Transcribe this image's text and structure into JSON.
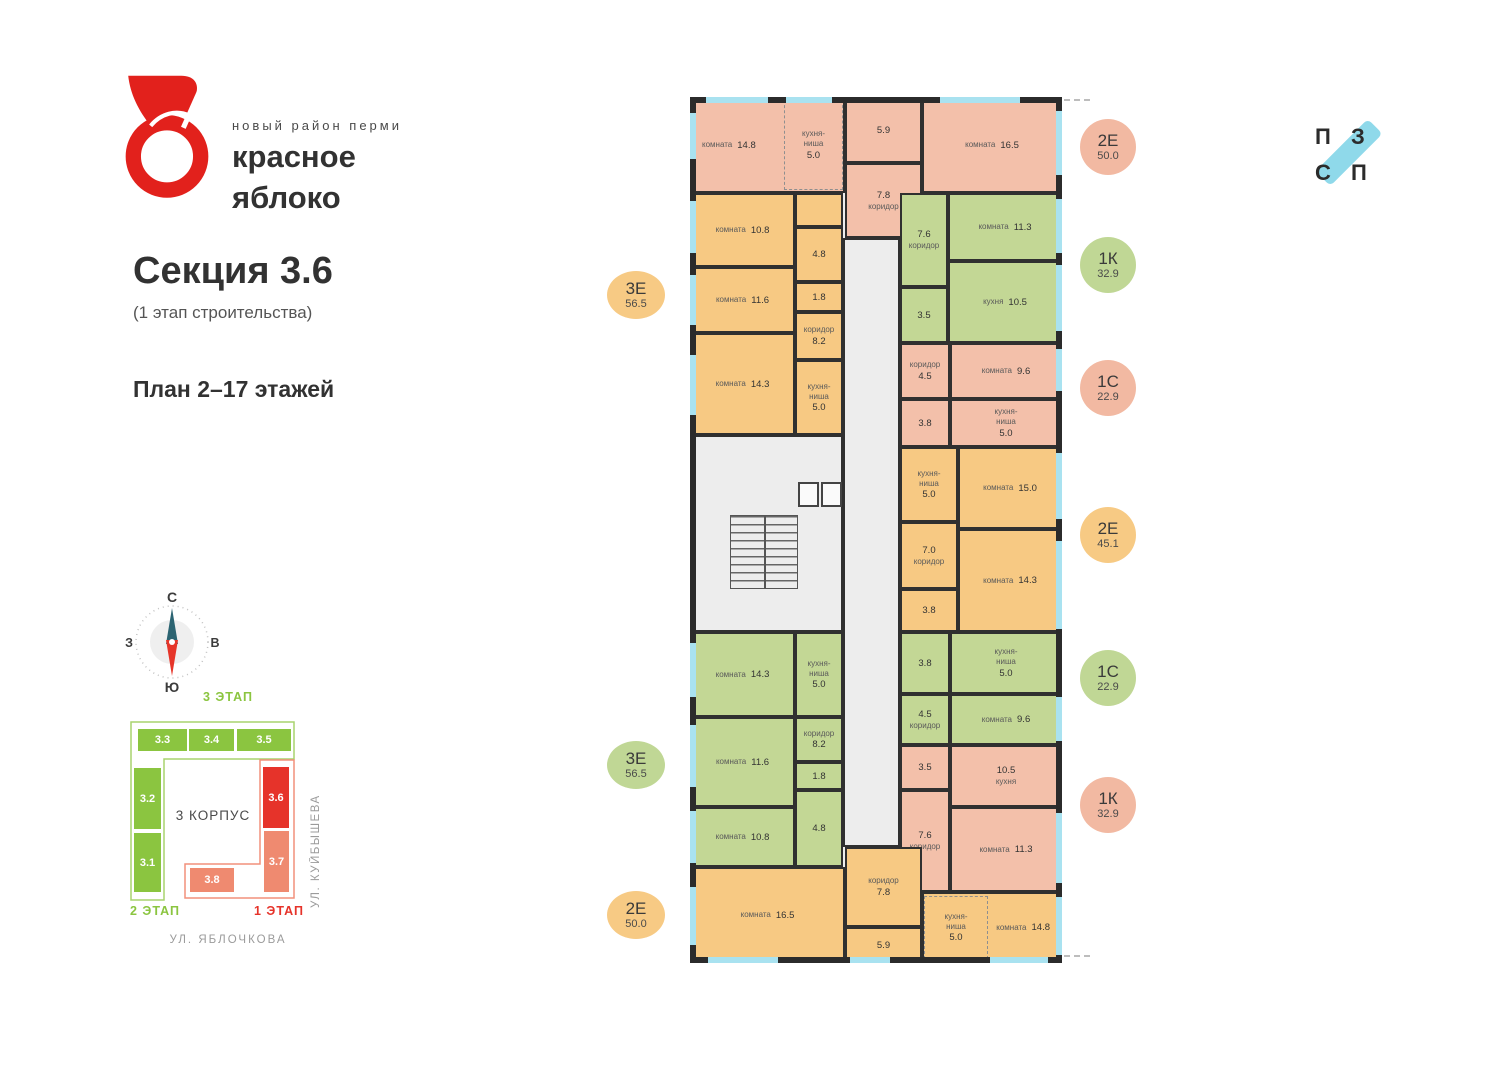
{
  "brand": {
    "tagline": "новый район перми",
    "line1": "красное",
    "line2": "яблоко"
  },
  "section": {
    "title": "Секция 3.6",
    "subtitle": "(1 этап строительства)",
    "floors": "План 2–17 этажей"
  },
  "compass": {
    "n": "С",
    "s": "Ю",
    "e": "В",
    "w": "З"
  },
  "partner": {
    "letters": [
      "П",
      "З",
      "С",
      "П"
    ],
    "bar_color": "#8fd9ea"
  },
  "minimap": {
    "stage3": "3 ЭТАП",
    "stage2": "2 ЭТАП",
    "stage1": "1 ЭТАП",
    "korpus": "3 КОРПУС",
    "street_right": "УЛ. КУЙБЫШЕВА",
    "street_bottom": "УЛ. ЯБЛОЧКОВА",
    "outline_green": "#a8d46e",
    "outline_red": "#f2907c",
    "sections": [
      {
        "label": "3.3",
        "color": "#8bc540",
        "r": [
          9,
          38,
          51,
          24
        ]
      },
      {
        "label": "3.4",
        "color": "#8bc540",
        "r": [
          60,
          38,
          47,
          24
        ]
      },
      {
        "label": "3.5",
        "color": "#8bc540",
        "r": [
          108,
          38,
          56,
          24
        ]
      },
      {
        "label": "3.2",
        "color": "#8bc540",
        "r": [
          5,
          77,
          29,
          63
        ]
      },
      {
        "label": "3.1",
        "color": "#8bc540",
        "r": [
          5,
          142,
          29,
          61
        ]
      },
      {
        "label": "3.6",
        "color": "#e6332a",
        "r": [
          134,
          76,
          28,
          63
        ]
      },
      {
        "label": "3.7",
        "color": "#ef8a70",
        "r": [
          135,
          140,
          27,
          63
        ]
      },
      {
        "label": "3.8",
        "color": "#ef8a70",
        "r": [
          61,
          177,
          46,
          26
        ]
      }
    ]
  },
  "badges_left": [
    {
      "t": "3Е",
      "a": "56.5",
      "color": "#f7ca84",
      "cy": 295
    },
    {
      "t": "3Е",
      "a": "56.5",
      "color": "#c0d795",
      "cy": 765
    },
    {
      "t": "2Е",
      "a": "50.0",
      "color": "#f7ca84",
      "cy": 915
    }
  ],
  "badges_right": [
    {
      "t": "2Е",
      "a": "50.0",
      "color": "#f2b9a2",
      "cy": 147
    },
    {
      "t": "1К",
      "a": "32.9",
      "color": "#c0d795",
      "cy": 265
    },
    {
      "t": "1С",
      "a": "22.9",
      "color": "#f2b9a2",
      "cy": 388
    },
    {
      "t": "2Е",
      "a": "45.1",
      "color": "#f7ca84",
      "cy": 535
    },
    {
      "t": "1С",
      "a": "22.9",
      "color": "#c0d795",
      "cy": 678
    },
    {
      "t": "1К",
      "a": "32.9",
      "color": "#f2b9a2",
      "cy": 805
    }
  ],
  "floorplan": {
    "colors": {
      "salmon": "#f3c0aa",
      "orange": "#f7c983",
      "green": "#c3d795",
      "common": "#ededed"
    },
    "rooms": [
      {
        "id": "corridor-central",
        "c": "common",
        "r": [
          153,
          141,
          57,
          609
        ]
      },
      {
        "id": "stair-core-block",
        "c": "common",
        "r": [
          0,
          338,
          153,
          197
        ]
      },
      {
        "id": "apt-2e50-top-room-1",
        "c": "salmon",
        "n": "комната",
        "a": "14.8",
        "r": [
          0,
          0,
          155,
          96
        ],
        "align": "L"
      },
      {
        "id": "apt-2e50-top-kitchen-niche",
        "c": "salmon",
        "n": "кухня-\nниша",
        "a": "5.0",
        "r": [
          94,
          3,
          59,
          90
        ],
        "dir": "col",
        "dashed": true
      },
      {
        "id": "apt-2e50-top-bath",
        "c": "salmon",
        "a": "5.9",
        "r": [
          155,
          0,
          77,
          66
        ]
      },
      {
        "id": "apt-2e50-top-hall",
        "c": "salmon",
        "n": "коридор",
        "a": "7.8",
        "r": [
          155,
          66,
          77,
          75
        ],
        "dir": "col",
        "af": true
      },
      {
        "id": "apt-2e50-top-room-2",
        "c": "salmon",
        "n": "комната",
        "a": "16.5",
        "r": [
          232,
          0,
          140,
          96
        ]
      },
      {
        "id": "apt-3e56-top-room-1",
        "c": "orange",
        "n": "комната",
        "a": "10.8",
        "r": [
          0,
          96,
          105,
          74
        ]
      },
      {
        "id": "apt-3e56-top-closet",
        "c": "orange",
        "r": [
          105,
          96,
          48,
          34
        ]
      },
      {
        "id": "apt-3e56-top-bath",
        "c": "orange",
        "a": "4.8",
        "r": [
          105,
          130,
          48,
          55
        ]
      },
      {
        "id": "apt-3e56-top-room-2",
        "c": "orange",
        "n": "комната",
        "a": "11.6",
        "r": [
          0,
          170,
          105,
          66
        ]
      },
      {
        "id": "apt-3e56-top-wc",
        "c": "orange",
        "a": "1.8",
        "r": [
          105,
          185,
          48,
          30
        ]
      },
      {
        "id": "apt-3e56-top-hall",
        "c": "orange",
        "n": "коридор",
        "a": "8.2",
        "r": [
          105,
          215,
          48,
          48
        ],
        "dir": "col"
      },
      {
        "id": "apt-3e56-top-room-3",
        "c": "orange",
        "n": "комната",
        "a": "14.3",
        "r": [
          0,
          236,
          105,
          102
        ]
      },
      {
        "id": "apt-3e56-top-kitchen-niche",
        "c": "orange",
        "n": "кухня-\nниша",
        "a": "5.0",
        "r": [
          105,
          263,
          48,
          75
        ],
        "dir": "col"
      },
      {
        "id": "apt-1k32-top-hall",
        "c": "green",
        "n": "коридор",
        "a": "7.6",
        "r": [
          210,
          96,
          48,
          94
        ],
        "dir": "col",
        "af": true
      },
      {
        "id": "apt-1k32-top-room",
        "c": "green",
        "n": "комната",
        "a": "11.3",
        "r": [
          258,
          96,
          114,
          68
        ]
      },
      {
        "id": "apt-1k32-top-bath",
        "c": "green",
        "a": "3.5",
        "r": [
          210,
          190,
          48,
          56
        ]
      },
      {
        "id": "apt-1k32-top-kitchen",
        "c": "green",
        "n": "кухня",
        "a": "10.5",
        "r": [
          258,
          164,
          114,
          82
        ]
      },
      {
        "id": "apt-1s22-top-hall",
        "c": "salmon",
        "n": "коридор",
        "a": "4.5",
        "r": [
          210,
          246,
          50,
          56
        ],
        "dir": "col"
      },
      {
        "id": "apt-1s22-top-room",
        "c": "salmon",
        "n": "комната",
        "a": "9.6",
        "r": [
          260,
          246,
          112,
          56
        ]
      },
      {
        "id": "apt-1s22-top-bath",
        "c": "salmon",
        "a": "3.8",
        "r": [
          210,
          302,
          50,
          48
        ]
      },
      {
        "id": "apt-1s22-top-kitchen-niche",
        "c": "salmon",
        "n": "кухня-\nниша",
        "a": "5.0",
        "r": [
          260,
          302,
          112,
          48
        ],
        "dir": "col"
      },
      {
        "id": "apt-2e45-kitchen-niche",
        "c": "orange",
        "n": "кухня-\nниша",
        "a": "5.0",
        "r": [
          210,
          350,
          58,
          75
        ],
        "dir": "col"
      },
      {
        "id": "apt-2e45-room-1",
        "c": "orange",
        "n": "комната",
        "a": "15.0",
        "r": [
          268,
          350,
          104,
          82
        ]
      },
      {
        "id": "apt-2e45-hall",
        "c": "orange",
        "n": "коридор",
        "a": "7.0",
        "r": [
          210,
          425,
          58,
          67
        ],
        "dir": "col",
        "af": true
      },
      {
        "id": "apt-2e45-room-2",
        "c": "orange",
        "n": "комната",
        "a": "14.3",
        "r": [
          268,
          432,
          104,
          103
        ]
      },
      {
        "id": "apt-2e45-bath",
        "c": "orange",
        "a": "3.8",
        "r": [
          210,
          492,
          58,
          43
        ]
      },
      {
        "id": "apt-1s22-mid-bath",
        "c": "green",
        "a": "3.8",
        "r": [
          210,
          535,
          50,
          62
        ]
      },
      {
        "id": "apt-1s22-mid-kitchen-niche",
        "c": "green",
        "n": "кухня-\nниша",
        "a": "5.0",
        "r": [
          260,
          535,
          112,
          62
        ],
        "dir": "col"
      },
      {
        "id": "apt-1s22-mid-hall",
        "c": "green",
        "n": "коридор",
        "a": "4.5",
        "r": [
          210,
          597,
          50,
          51
        ],
        "dir": "col",
        "af": true
      },
      {
        "id": "apt-1s22-mid-room",
        "c": "green",
        "n": "комната",
        "a": "9.6",
        "r": [
          260,
          597,
          112,
          51
        ]
      },
      {
        "id": "apt-1k32-bottom-bath",
        "c": "salmon",
        "a": "3.5",
        "r": [
          210,
          648,
          50,
          45
        ]
      },
      {
        "id": "apt-1k32-bottom-kitchen",
        "c": "salmon",
        "n": "кухня",
        "a": "10.5",
        "r": [
          260,
          648,
          112,
          62
        ],
        "dir": "col",
        "af": true
      },
      {
        "id": "apt-1k32-bottom-hall",
        "c": "salmon",
        "n": "коридор",
        "a": "7.6",
        "r": [
          210,
          693,
          50,
          102
        ],
        "dir": "col",
        "af": true
      },
      {
        "id": "apt-1k32-bottom-room",
        "c": "salmon",
        "n": "комната",
        "a": "11.3",
        "r": [
          260,
          710,
          112,
          85
        ]
      },
      {
        "id": "apt-3e56-bottom-room-1",
        "c": "green",
        "n": "комната",
        "a": "14.3",
        "r": [
          0,
          535,
          105,
          85
        ]
      },
      {
        "id": "apt-3e56-bottom-kitchen-niche",
        "c": "green",
        "n": "кухня-\nниша",
        "a": "5.0",
        "r": [
          105,
          535,
          48,
          85
        ],
        "dir": "col"
      },
      {
        "id": "apt-3e56-bottom-hall",
        "c": "green",
        "n": "коридор",
        "a": "8.2",
        "r": [
          105,
          620,
          48,
          45
        ],
        "dir": "col"
      },
      {
        "id": "apt-3e56-bottom-room-2",
        "c": "green",
        "n": "комната",
        "a": "11.6",
        "r": [
          0,
          620,
          105,
          90
        ]
      },
      {
        "id": "apt-3e56-bottom-wc",
        "c": "green",
        "a": "1.8",
        "r": [
          105,
          665,
          48,
          28
        ]
      },
      {
        "id": "apt-3e56-bottom-bath",
        "c": "green",
        "a": "4.8",
        "r": [
          105,
          693,
          48,
          77
        ]
      },
      {
        "id": "apt-3e56-bottom-room-3",
        "c": "green",
        "n": "комната",
        "a": "10.8",
        "r": [
          0,
          710,
          105,
          60
        ]
      },
      {
        "id": "apt-2e50-bottom-room-1",
        "c": "orange",
        "n": "комната",
        "a": "16.5",
        "r": [
          0,
          770,
          155,
          96
        ]
      },
      {
        "id": "apt-2e50-bottom-hall",
        "c": "orange",
        "n": "коридор",
        "a": "7.8",
        "r": [
          155,
          750,
          77,
          80
        ],
        "dir": "col"
      },
      {
        "id": "apt-2e50-bottom-bath",
        "c": "orange",
        "a": "5.9",
        "r": [
          155,
          830,
          77,
          36
        ]
      },
      {
        "id": "apt-2e50-bottom-room-2",
        "c": "orange",
        "n": "комната",
        "a": "14.8",
        "r": [
          232,
          795,
          140,
          71
        ],
        "align": "R"
      },
      {
        "id": "apt-2e50-bottom-kitchen-niche",
        "c": "orange",
        "n": "кухня-\nниша",
        "a": "5.0",
        "r": [
          234,
          799,
          64,
          63
        ],
        "dir": "col",
        "dashed": true
      }
    ],
    "walls": [
      [
        0,
        0,
        372,
        6
      ],
      [
        0,
        860,
        372,
        6
      ],
      [
        0,
        0,
        6,
        866
      ],
      [
        366,
        0,
        6,
        866
      ]
    ],
    "stairs": [
      40,
      418,
      68,
      74
    ],
    "lifts": [
      [
        108,
        385,
        21,
        25
      ],
      [
        131,
        385,
        21,
        25
      ]
    ],
    "dashes": [
      [
        374,
        2,
        26
      ],
      [
        374,
        858,
        26
      ]
    ],
    "windows": [
      [
        0,
        16,
        6,
        46
      ],
      [
        0,
        104,
        6,
        52
      ],
      [
        0,
        178,
        6,
        50
      ],
      [
        0,
        258,
        6,
        60
      ],
      [
        0,
        546,
        6,
        54
      ],
      [
        0,
        628,
        6,
        62
      ],
      [
        0,
        714,
        6,
        52
      ],
      [
        0,
        790,
        6,
        58
      ],
      [
        366,
        14,
        6,
        64
      ],
      [
        366,
        102,
        6,
        54
      ],
      [
        366,
        168,
        6,
        66
      ],
      [
        366,
        252,
        6,
        42
      ],
      [
        366,
        356,
        6,
        66
      ],
      [
        366,
        444,
        6,
        88
      ],
      [
        366,
        600,
        6,
        44
      ],
      [
        366,
        716,
        6,
        70
      ],
      [
        366,
        800,
        6,
        58
      ],
      [
        16,
        0,
        62,
        6
      ],
      [
        96,
        0,
        46,
        6
      ],
      [
        250,
        0,
        80,
        6
      ],
      [
        18,
        860,
        70,
        6
      ],
      [
        160,
        860,
        40,
        6
      ],
      [
        300,
        860,
        58,
        6
      ]
    ]
  }
}
